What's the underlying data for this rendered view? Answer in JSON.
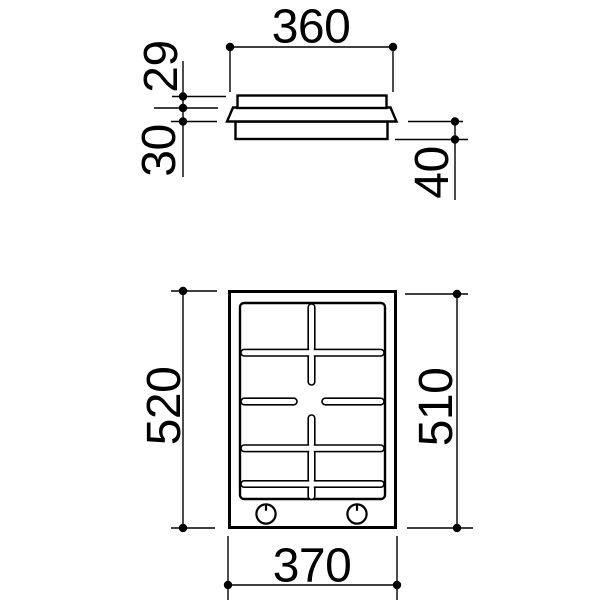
{
  "page": {
    "background": "#ffffff"
  },
  "drawing": {
    "line_color": "#000000",
    "side_view": {
      "dims": {
        "width": "360",
        "upper_height": "29",
        "lower_height": "30",
        "recess_height": "40"
      }
    },
    "plan_view": {
      "dims": {
        "overall_depth": "520",
        "inner_depth": "510",
        "overall_width": "370"
      },
      "knob_count": 2,
      "burner_grid": {
        "rows": 4,
        "columns": 2,
        "bottom_strip": true,
        "center_cross_gap": true
      }
    }
  }
}
